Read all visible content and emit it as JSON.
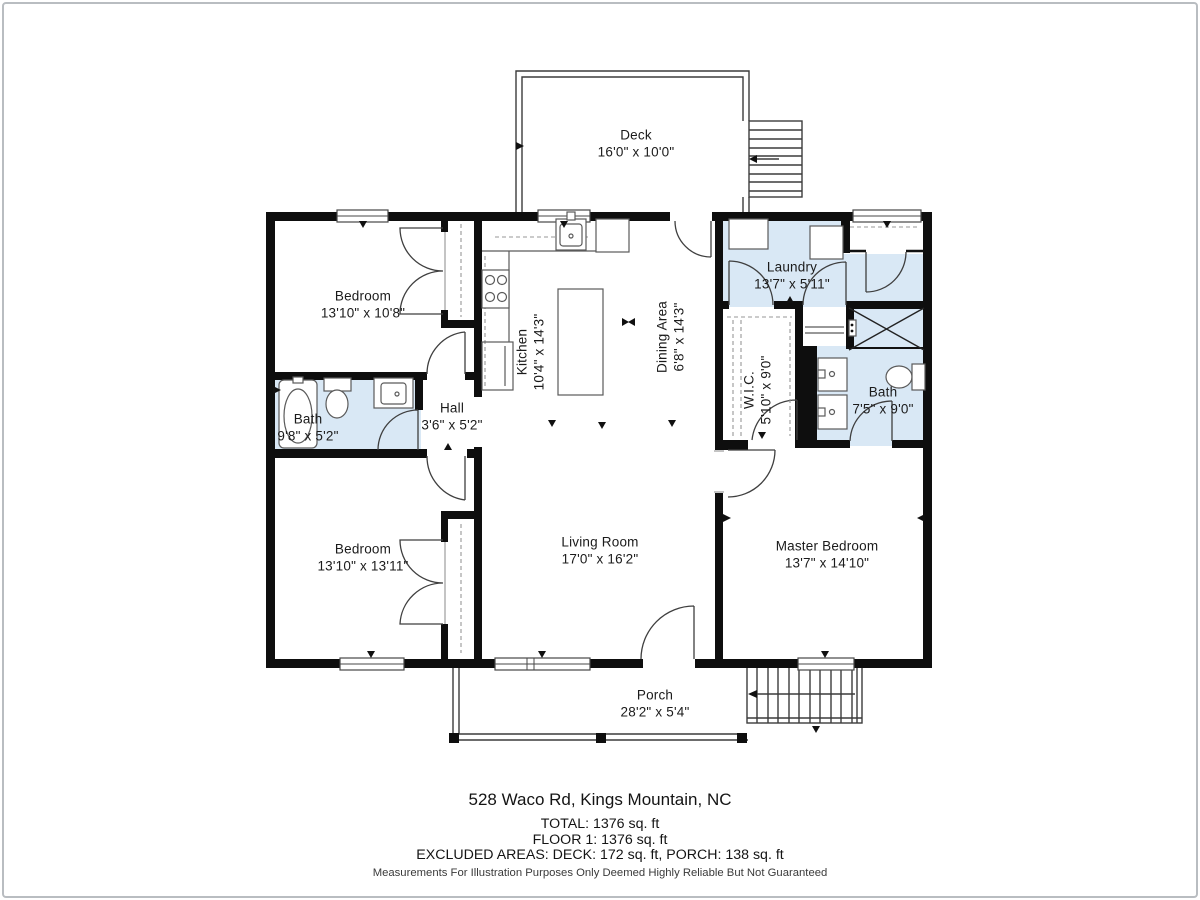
{
  "title": "Floor plan - 528 Waco Rd, Kings Mountain, NC",
  "colors": {
    "wall": "#0e0e0e",
    "wet_room_fill": "#d9e8f5",
    "line": "#3f3f3f",
    "frame_border": "#b9bdc1"
  },
  "rooms": [
    {
      "id": "deck",
      "name": "Deck",
      "dims": "16'0\" x 10'0\""
    },
    {
      "id": "bedroom1",
      "name": "Bedroom",
      "dims": "13'10\" x 10'8\""
    },
    {
      "id": "kitchen",
      "name": "Kitchen",
      "dims": "10'4\" x 14'3\""
    },
    {
      "id": "dining",
      "name": "Dining Area",
      "dims": "6'8\" x 14'3\""
    },
    {
      "id": "laundry",
      "name": "Laundry",
      "dims": "13'7\" x 5'11\""
    },
    {
      "id": "bath1",
      "name": "Bath",
      "dims": "9'8\" x 5'2\""
    },
    {
      "id": "hall",
      "name": "Hall",
      "dims": "3'6\" x 5'2\""
    },
    {
      "id": "wic",
      "name": "W.I.C.",
      "dims": "5'10\" x 9'0\""
    },
    {
      "id": "bath2",
      "name": "Bath",
      "dims": "7'5\" x 9'0\""
    },
    {
      "id": "bedroom2",
      "name": "Bedroom",
      "dims": "13'10\" x 13'11\""
    },
    {
      "id": "living",
      "name": "Living Room",
      "dims": "17'0\" x 16'2\""
    },
    {
      "id": "master",
      "name": "Master Bedroom",
      "dims": "13'7\" x 14'10\""
    },
    {
      "id": "porch",
      "name": "Porch",
      "dims": "28'2\" x 5'4\""
    }
  ],
  "footer": {
    "address": "528 Waco Rd, Kings Mountain, NC",
    "total": "TOTAL: 1376 sq. ft",
    "floor": "FLOOR 1: 1376 sq. ft",
    "excluded": "EXCLUDED AREAS: DECK: 172 sq. ft, PORCH: 138 sq. ft",
    "disclaimer": "Measurements For Illustration Purposes Only Deemed Highly Reliable But Not Guaranteed"
  }
}
